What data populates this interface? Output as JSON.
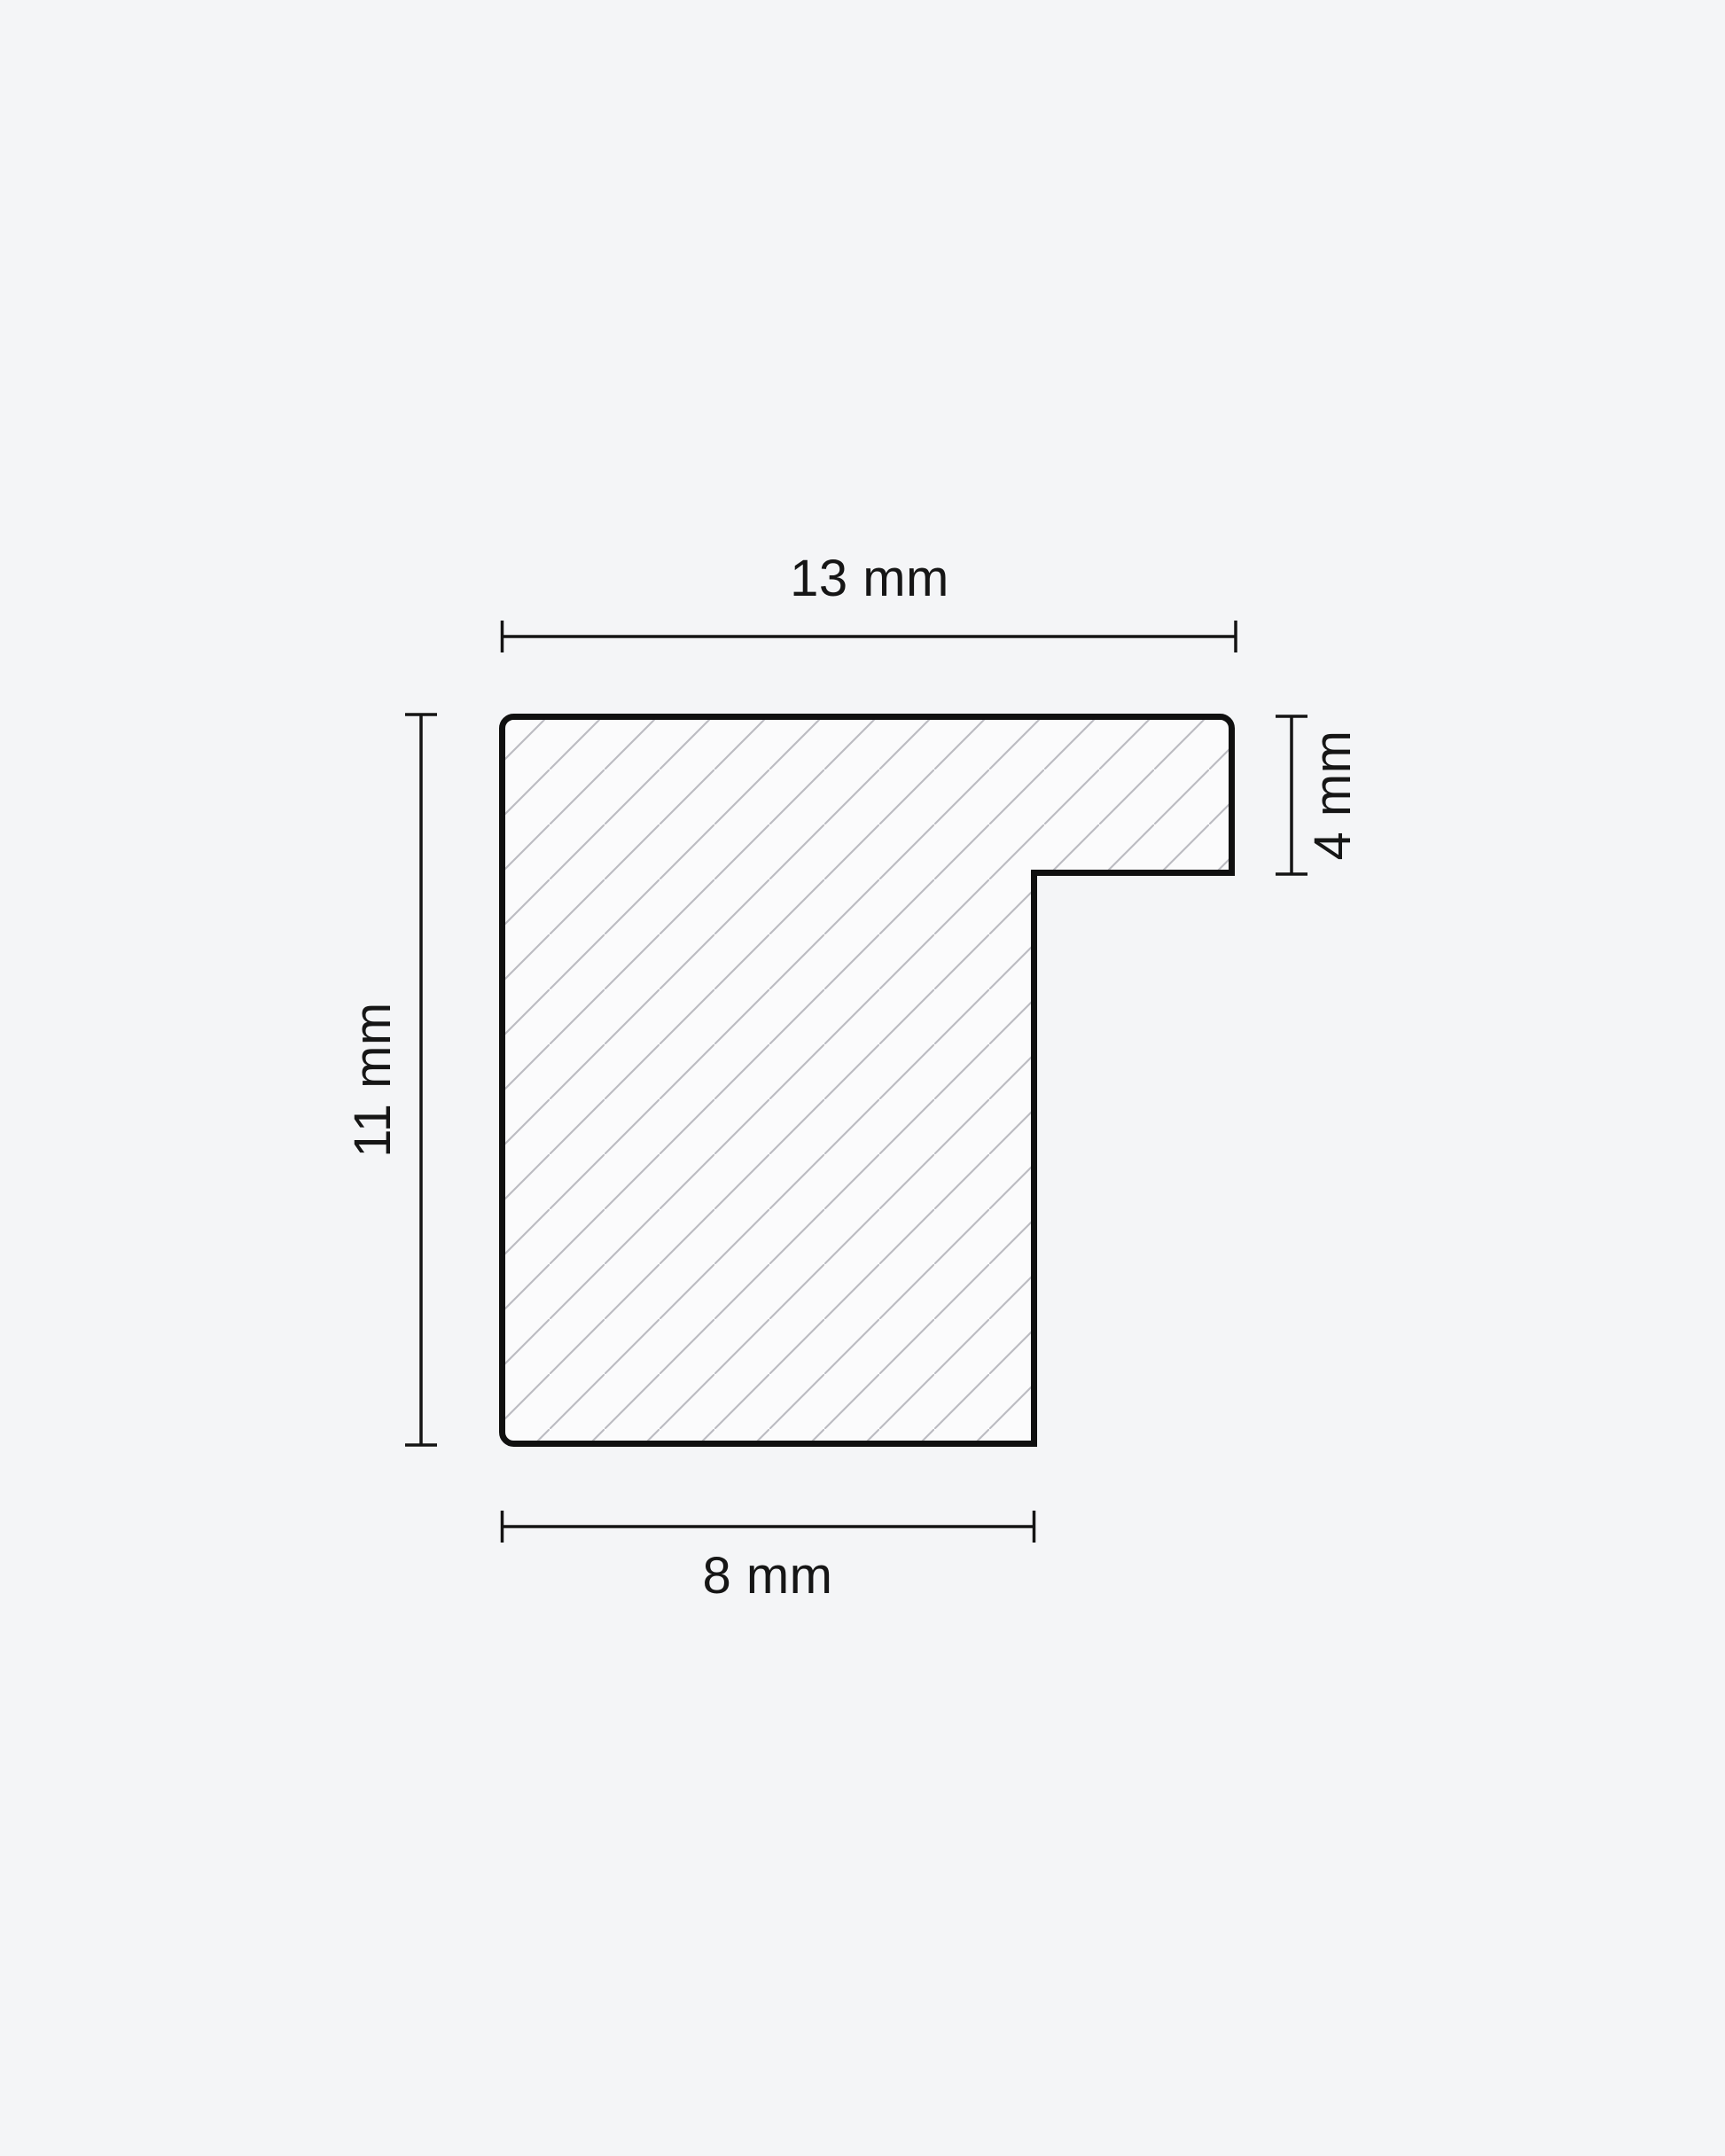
{
  "page": {
    "background_color": "#f4f5f7"
  },
  "diagram": {
    "type": "technical-cross-section",
    "subject": "frame-moulding-profile",
    "unit": "mm",
    "dimensions": {
      "top_width": {
        "value": 13,
        "unit": "mm",
        "label": "13 mm",
        "side": "top"
      },
      "left_height": {
        "value": 11,
        "unit": "mm",
        "label": "11 mm",
        "side": "left"
      },
      "right_rabbet": {
        "value": 4,
        "unit": "mm",
        "label": "4 mm",
        "side": "right"
      },
      "bottom_width": {
        "value": 8,
        "unit": "mm",
        "label": "8 mm",
        "side": "bottom"
      }
    },
    "style": {
      "outline_color": "#101010",
      "dimension_line_color": "#141414",
      "hatch_color": "#bcbcc2",
      "fill_color": "#fbfbfc",
      "text_color": "#161616"
    }
  }
}
